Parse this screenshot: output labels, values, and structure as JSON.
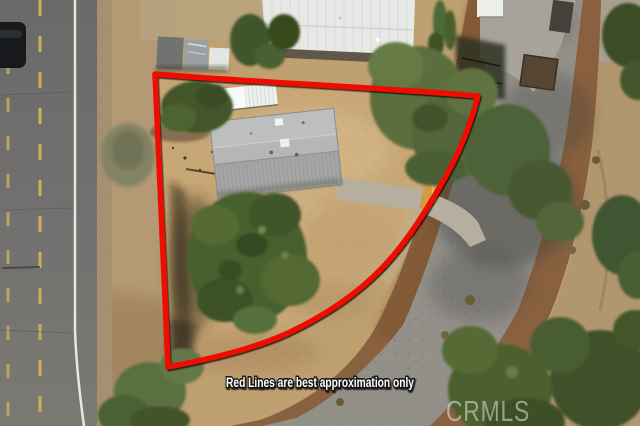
{
  "photo": {
    "kind": "aerial-lot-photo",
    "subject": "vacant corner lot with manufactured home, bounded by two roads"
  },
  "annotations": {
    "disclaimer_text": "Red Lines are best approximation only",
    "watermark_text": "CRMLS",
    "boundary_color": "#ee0d06",
    "boundary_stroke_width": 5.5,
    "boundary_path": "M 155 74 C 250 82 390 88 478 96 C 471 123 460 151 446 176 C 428 208 407 242 382 268 C 354 297 322 317 288 333 C 253 349 210 359 168 367 Z",
    "disclaimer_color": "#ffffff",
    "disclaimer_outline": "#141414",
    "watermark_color": "#ffffff"
  }
}
